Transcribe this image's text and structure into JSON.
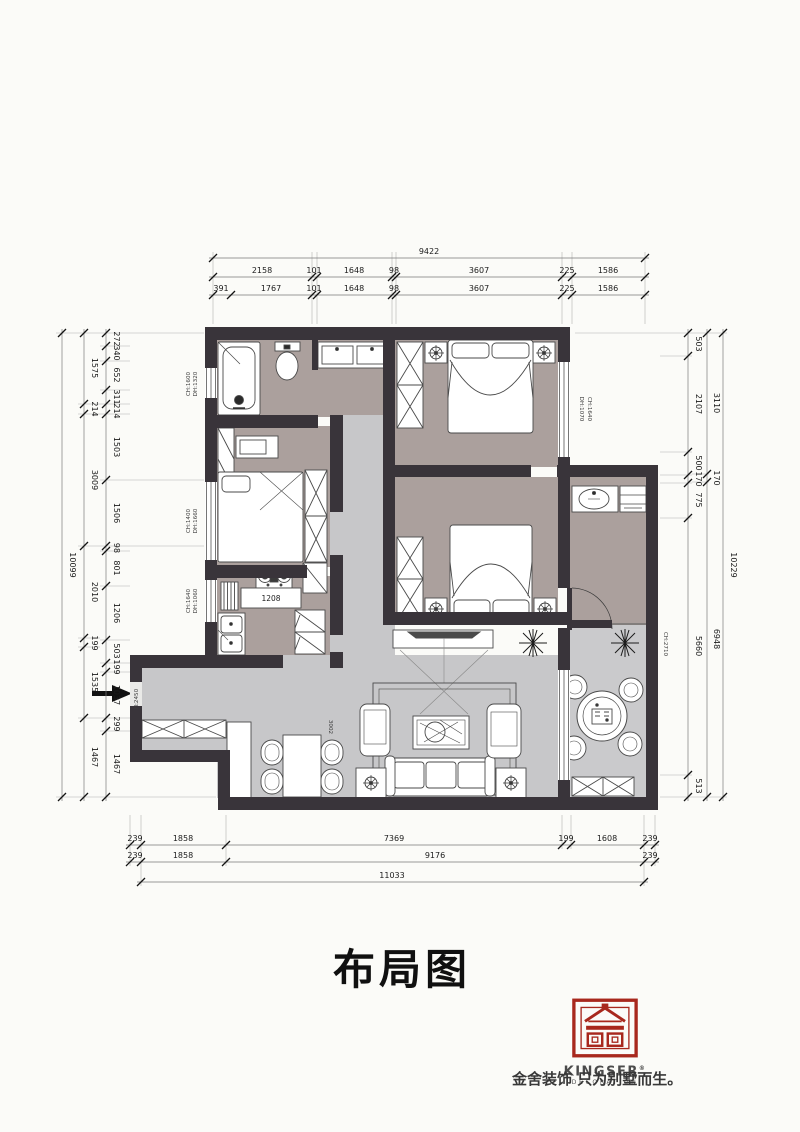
{
  "title": "布局图",
  "logo": {
    "brand": "KINGSER",
    "reg": "®",
    "sub": "DECORATION",
    "tagline": "金舍装饰 只为别墅而生。",
    "red": "#a8281d"
  },
  "colors": {
    "wall": "#39343a",
    "bedroom_floor": "#aba09d",
    "hall_floor": "#c7c7c9",
    "balcony_floor": "#cacacc"
  },
  "dims": {
    "top": {
      "total": "9422",
      "row_mid": [
        "2158",
        "101",
        "1648",
        "98",
        "3607",
        "225",
        "1586"
      ],
      "row_inner": [
        "391",
        "1767",
        "101",
        "1648",
        "98",
        "3607",
        "225",
        "1586"
      ]
    },
    "bottom": {
      "row_inner": [
        "239",
        "1858",
        "7369",
        "199",
        "1608",
        "239"
      ],
      "row_mid": [
        "239",
        "1858",
        "9176",
        "239"
      ],
      "total": "11033"
    },
    "left": {
      "total": "10099",
      "mid": [
        "1575",
        "214",
        "3009",
        "2010",
        "199",
        "1535",
        "1467"
      ],
      "inner": [
        "272",
        "340",
        "652",
        "311",
        "214",
        "1503",
        "1506",
        "98",
        "801",
        "1206",
        "503",
        "199",
        "1037",
        "299",
        "1467"
      ]
    },
    "right": {
      "total": "10229",
      "mid": [
        "3110",
        "170",
        "6948"
      ],
      "inner": [
        "503",
        "2107",
        "500",
        "170",
        "775",
        "5660",
        "513"
      ]
    }
  },
  "annotations": {
    "bath_window": [
      "CH:1600",
      "DH:1320"
    ],
    "bedroom_window": [
      "CH:1400",
      "DH:1660"
    ],
    "kitchen_window": [
      "CH:1640",
      "DH:1060"
    ],
    "master_window": [
      "DH:1070",
      "CH:1640"
    ],
    "balcony_height": "CH:2710",
    "entry_height": "H:2450",
    "counter_width": "1208",
    "dining_width": "3002"
  }
}
